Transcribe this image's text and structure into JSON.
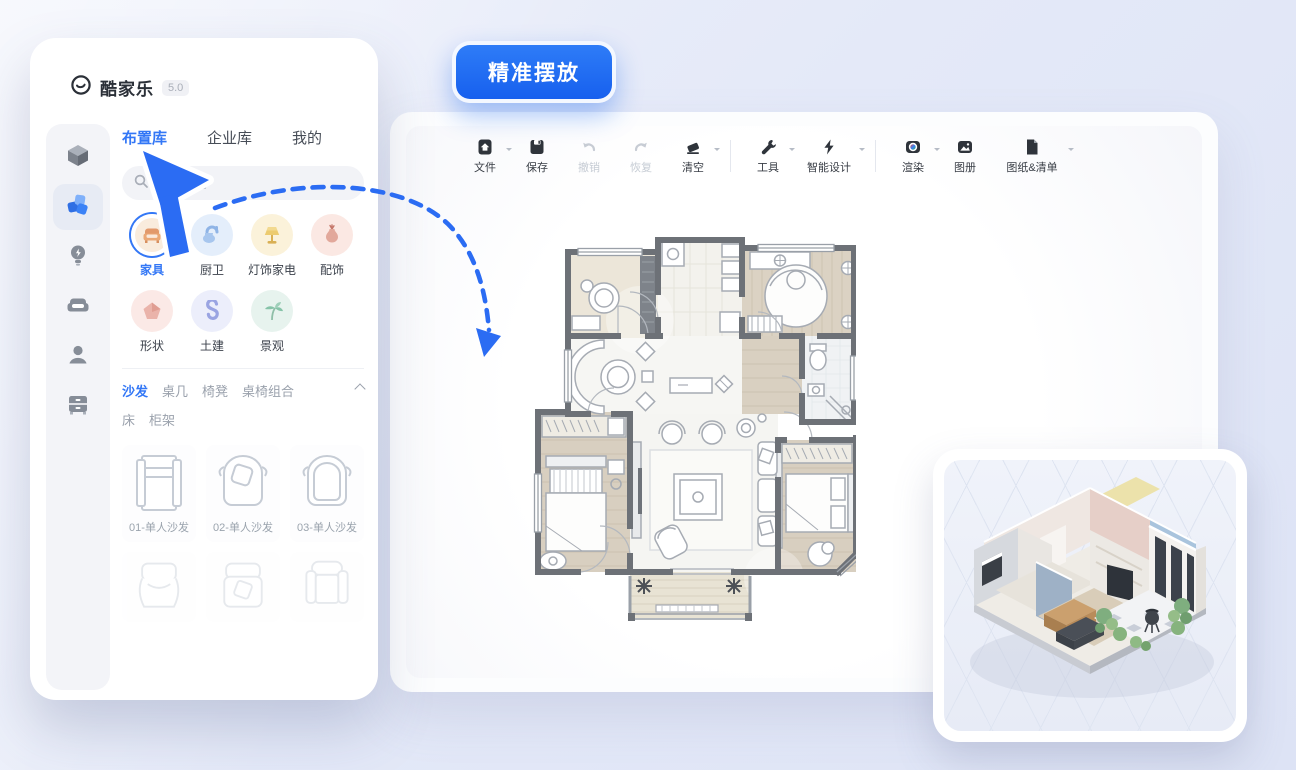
{
  "badge": {
    "label": "精准摆放"
  },
  "panel": {
    "brand": {
      "name": "酷家乐",
      "version": "5.0"
    },
    "tabs": [
      {
        "label": "布置库",
        "active": true
      },
      {
        "label": "企业库",
        "active": false
      },
      {
        "label": "我的",
        "active": false
      }
    ],
    "search": {
      "placeholder": "搜索素材",
      "icon": "search-icon"
    },
    "rail": [
      {
        "icon": "cube-icon",
        "active": false
      },
      {
        "icon": "blocks-icon",
        "active": true
      },
      {
        "icon": "bulb-icon",
        "active": false
      },
      {
        "icon": "sofa-icon",
        "active": false
      },
      {
        "icon": "person-icon",
        "active": false
      },
      {
        "icon": "cabinet-icon",
        "active": false
      }
    ],
    "categories": [
      {
        "label": "家具",
        "icon": "furniture-icon",
        "active": true
      },
      {
        "label": "厨卫",
        "icon": "kitchen-bath-icon",
        "active": false
      },
      {
        "label": "灯饰家电",
        "icon": "lighting-appliance-icon",
        "active": false
      },
      {
        "label": "配饰",
        "icon": "decor-icon",
        "active": false
      },
      {
        "label": "形状",
        "icon": "shape-icon",
        "active": false
      },
      {
        "label": "土建",
        "icon": "construction-icon",
        "active": false
      },
      {
        "label": "景观",
        "icon": "landscape-icon",
        "active": false
      }
    ],
    "subcategories_row1": [
      {
        "label": "沙发",
        "active": true
      },
      {
        "label": "桌几",
        "active": false
      },
      {
        "label": "椅凳",
        "active": false
      },
      {
        "label": "桌椅组合",
        "active": false
      }
    ],
    "subcategories_row2": [
      {
        "label": "床",
        "active": false
      },
      {
        "label": "柜架",
        "active": false
      }
    ],
    "collapse_icon": "chevron-up-icon",
    "products": [
      {
        "label": "01-单人沙发"
      },
      {
        "label": "02-单人沙发"
      },
      {
        "label": "03-单人沙发"
      }
    ]
  },
  "toolbar": {
    "items": [
      {
        "label": "文件",
        "icon": "file-icon",
        "caret": true,
        "disabled": false
      },
      {
        "label": "保存",
        "icon": "save-icon",
        "caret": false,
        "disabled": false
      },
      {
        "label": "撤销",
        "icon": "undo-icon",
        "caret": false,
        "disabled": true
      },
      {
        "label": "恢复",
        "icon": "redo-icon",
        "caret": false,
        "disabled": true
      },
      {
        "label": "清空",
        "icon": "eraser-icon",
        "caret": true,
        "disabled": false
      },
      {
        "label": "工具",
        "icon": "wrench-icon",
        "caret": true,
        "disabled": false
      },
      {
        "label": "智能设计",
        "icon": "bolt-icon",
        "caret": true,
        "disabled": false
      },
      {
        "label": "渲染",
        "icon": "camera-icon",
        "caret": true,
        "disabled": false
      },
      {
        "label": "图册",
        "icon": "album-icon",
        "caret": false,
        "disabled": false
      },
      {
        "label": "图纸&清单",
        "icon": "sheet-icon",
        "caret": true,
        "disabled": false
      }
    ]
  },
  "colors": {
    "accent": "#2b6cf3",
    "badge_blue": "#1e6bf3",
    "wall_gray": "#6d7177"
  }
}
